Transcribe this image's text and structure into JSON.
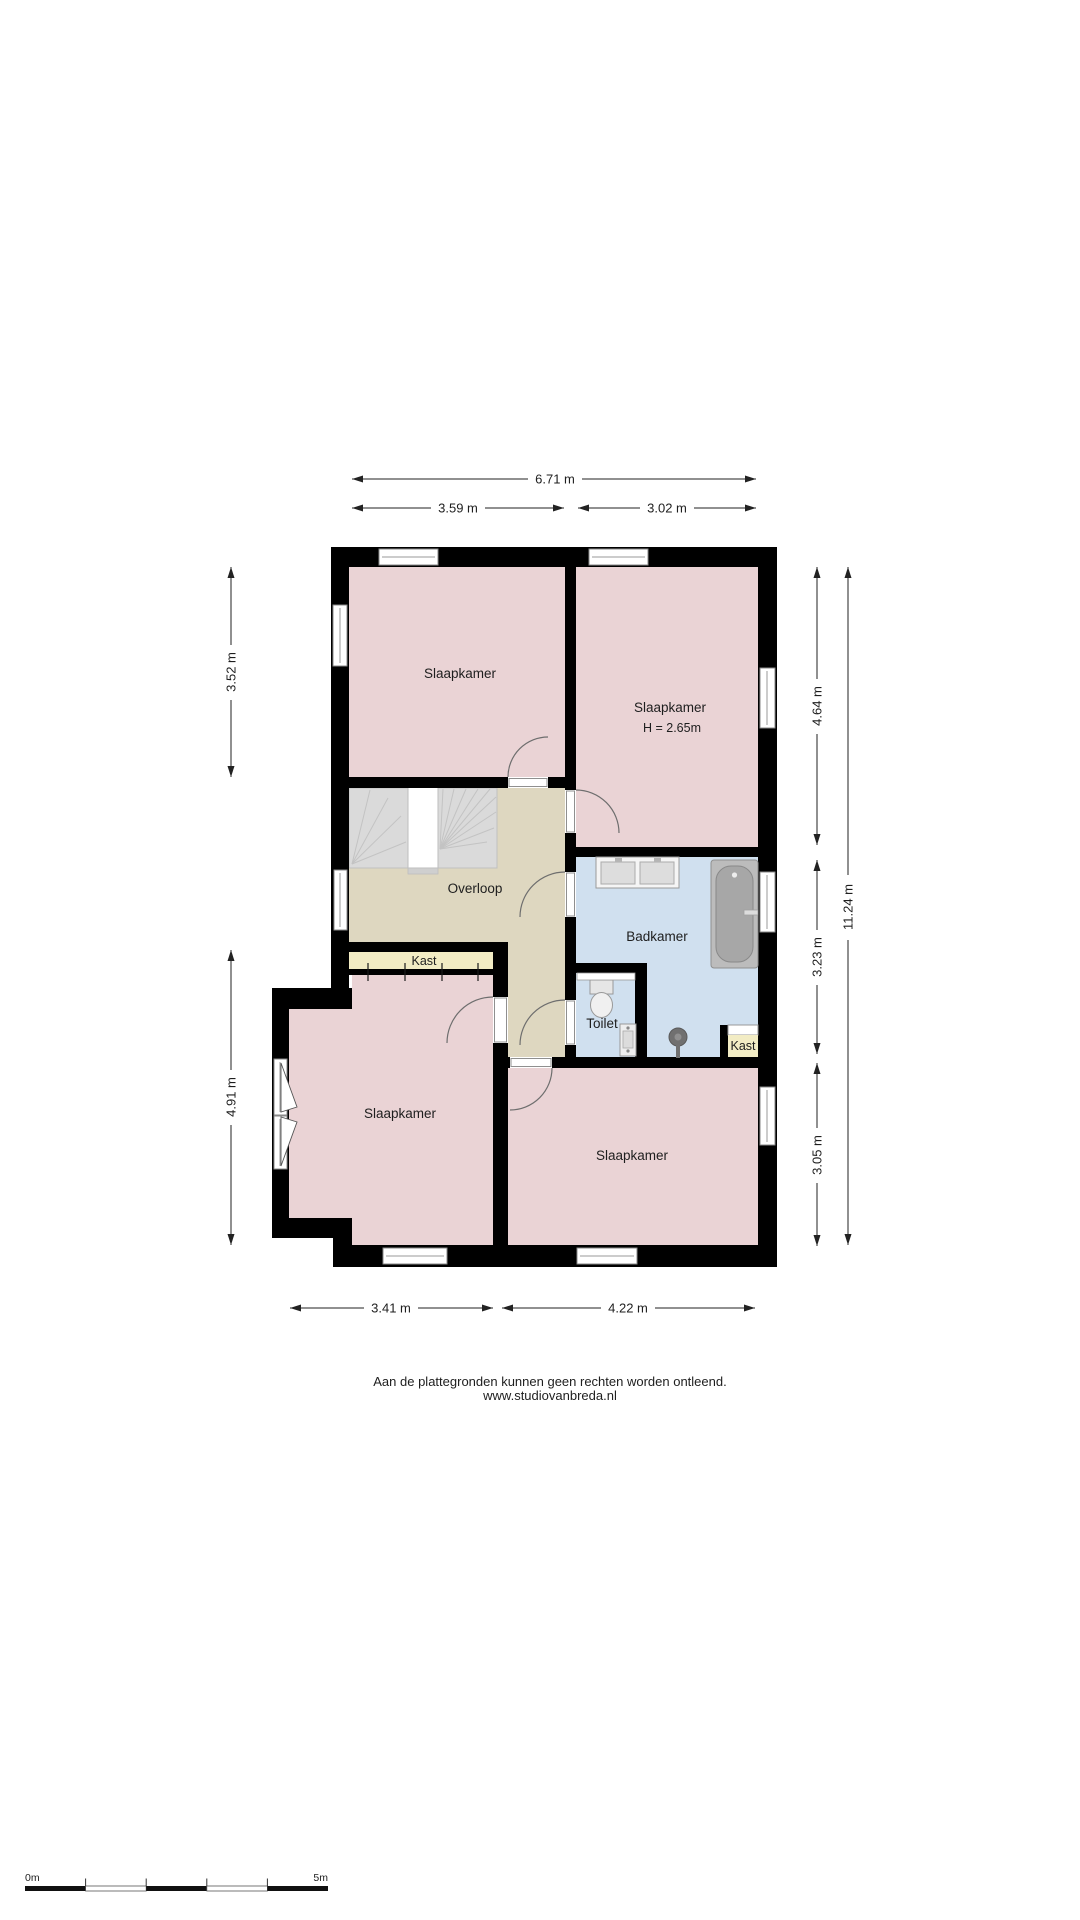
{
  "rooms": {
    "bedroom_top_left": {
      "label": "Slaapkamer"
    },
    "bedroom_top_right": {
      "label": "Slaapkamer",
      "height_note": "H = 2.65m"
    },
    "landing": {
      "label": "Overloop"
    },
    "closet_hall": {
      "label": "Kast"
    },
    "bathroom": {
      "label": "Badkamer"
    },
    "toilet": {
      "label": "Toilet"
    },
    "closet_bathroom": {
      "label": "Kast"
    },
    "bedroom_bottom_left": {
      "label": "Slaapkamer"
    },
    "bedroom_bottom_right": {
      "label": "Slaapkamer"
    }
  },
  "dimensions": {
    "top_total": "6.71 m",
    "top_left_room": "3.59 m",
    "top_right_room": "3.02 m",
    "left_upper": "3.52 m",
    "left_lower": "4.91 m",
    "right_upper": "4.64 m",
    "right_middle": "3.23 m",
    "right_lower": "3.05 m",
    "right_total": "11.24 m",
    "bottom_left_room": "3.41 m",
    "bottom_right_room": "4.22 m"
  },
  "footer": {
    "disclaimer": "Aan de plattegronden kunnen geen rechten worden ontleend.",
    "website": "www.studiovanbreda.nl"
  },
  "scale_bar": {
    "start_label": "0m",
    "end_label": "5m"
  },
  "colors": {
    "wall": "#000000",
    "bedroom_fill": "#ead3d5",
    "landing_fill": "#ded7c0",
    "closet_fill": "#f2ecc4",
    "bathroom_fill": "#d0e0ef",
    "stairs_fill": "#dadada"
  }
}
